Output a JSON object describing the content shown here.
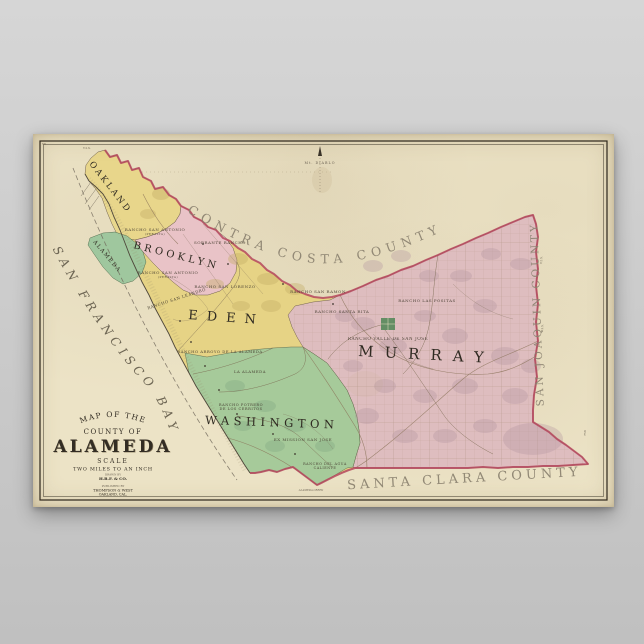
{
  "poster": {
    "paper_color": "#ece3c6",
    "boundary_color": "#b5465d",
    "plate_number": "758",
    "corner_number": "58",
    "title_block": {
      "line1": "MAP OF THE",
      "line2": "COUNTY OF",
      "line3": "ALAMEDA",
      "scale_label": "SCALE",
      "scale_value": "TWO MILES TO AN INCH",
      "drawn_by_label": "DRAWN BY",
      "drawn_by_name": "H.B.F. & CO.",
      "publisher_prefix": "PUBLISHED BY",
      "publisher_name": "THOMPSON & WEST",
      "publisher_city": "OAKLAND, CAL."
    },
    "counties": {
      "contra_costa": "CONTRA COSTA COUNTY",
      "san_joaquin": "SAN JOAQUIN COUNTY",
      "santa_clara": "SANTA CLARA COUNTY"
    },
    "water": {
      "bay": "SAN FRANCISCO BAY"
    },
    "landmarks": {
      "mt_diablo": "Mt. DIABLO",
      "creek": "ALAMEDA CREEK"
    },
    "ticks": {
      "top": "T.2.S.",
      "right_upper": "T.2.S.",
      "right_lower": "T.3.S."
    },
    "townships": [
      {
        "label": "OAKLAND",
        "color": "#e9d78c"
      },
      {
        "label": "BROOKLYN",
        "color": "#eac3ca"
      },
      {
        "label": "ALAMEDA",
        "color": "#9dc79d"
      },
      {
        "label": "EDEN",
        "color": "#e6d385"
      },
      {
        "label": "WASHINGTON",
        "color": "#a3ca9c"
      },
      {
        "label": "MURRAY",
        "color": "#debcc3"
      }
    ],
    "ranchos": [
      {
        "label": "RANCHO SAN ANTONIO",
        "sub": "(PERALTA)"
      },
      {
        "label": "SOBRANTE RANCHO",
        "sub": ""
      },
      {
        "label": "RANCHO SAN ANTONIO",
        "sub": "(PERALTA)"
      },
      {
        "label": "RANCHO SAN LEANDRO",
        "sub": ""
      },
      {
        "label": "RANCHO SAN LORENZO",
        "sub": ""
      },
      {
        "label": "RANCHO SAN RAMON",
        "sub": ""
      },
      {
        "label": "RANCHO SANTA RITA",
        "sub": ""
      },
      {
        "label": "RANCHO LAS POSITAS",
        "sub": ""
      },
      {
        "label": "RANCHO VALLE DE SAN JOSE",
        "sub": ""
      },
      {
        "label": "RANCHO ARROYO DE LA ALAMEDA",
        "sub": ""
      },
      {
        "label": "LA ALAMEDA",
        "sub": ""
      },
      {
        "label": "RANCHO POTRERO",
        "sub": "DE LOS CERRITOS"
      },
      {
        "label": "EX MISSION SAN JOSE",
        "sub": ""
      },
      {
        "label": "RANCHO DEL AGUA",
        "sub": "CALIENTE"
      }
    ]
  }
}
